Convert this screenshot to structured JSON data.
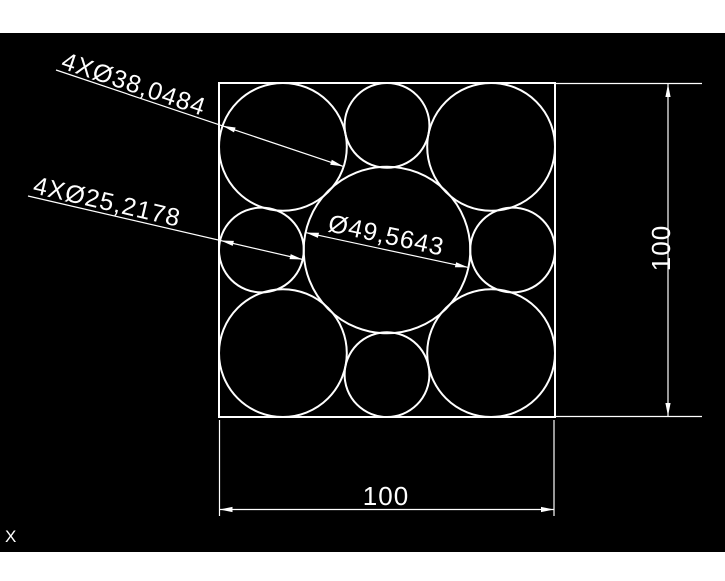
{
  "colors": {
    "canvas_background": "#000000",
    "drawing_lines": "#ffffff",
    "window_chrome": "#ffffff"
  },
  "drawing": {
    "dim_corner_circles_label": "4XØ38,0484",
    "dim_edge_circles_label": "4XØ25,2178",
    "dim_center_circle_label": "Ø49,5643",
    "dim_width_label": "100",
    "dim_height_label": "100",
    "ucs_axis_label": "X"
  }
}
